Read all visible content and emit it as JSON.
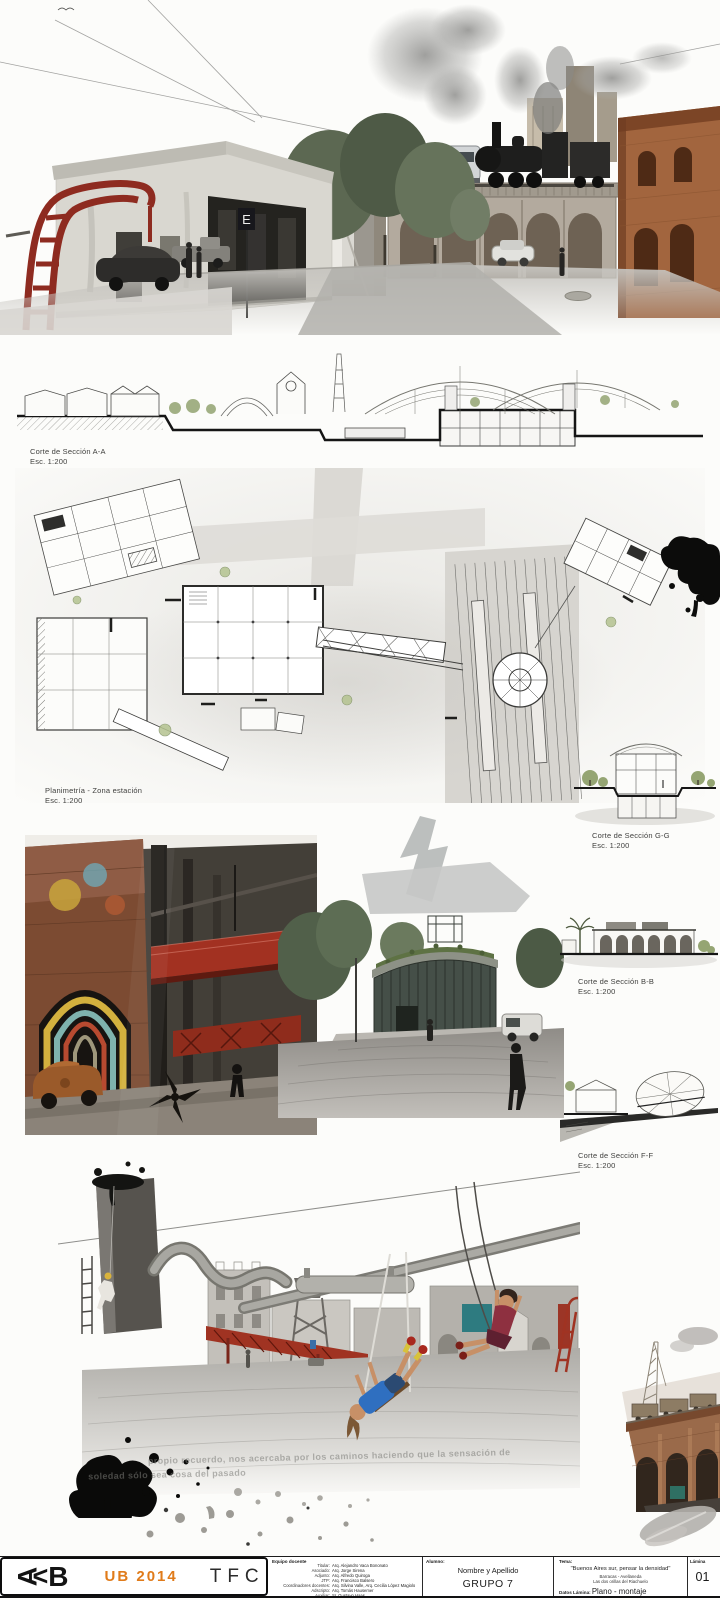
{
  "labels": {
    "section_aa": {
      "title": "Corte de Sección A-A",
      "scale": "Esc. 1:200"
    },
    "plan": {
      "title": "Planimetría - Zona estación",
      "scale": "Esc. 1:200"
    },
    "section_gg": {
      "title": "Corte de Sección G-G",
      "scale": "Esc. 1:200"
    },
    "section_bb": {
      "title": "Corte de Sección B-B",
      "scale": "Esc. 1:200"
    },
    "section_ff": {
      "title": "Corte de Sección F-F",
      "scale": "Esc. 1:200"
    }
  },
  "overlay_quote": {
    "line1": "propio recuerdo, nos acercaba por los caminos haciendo que la sensación de",
    "line2": "soledad sólo sea cosa del pasado"
  },
  "titleblock": {
    "logo": {
      "a": "A",
      "lt": "<",
      "b": "B"
    },
    "ub": "UB 2014",
    "tfc": "TFC",
    "equipo": {
      "heading": "Equipo docente",
      "rows": [
        {
          "role": "Titular:",
          "name": "Arq. Alejandro Vaca Bononato"
        },
        {
          "role": "Asociado:",
          "name": "Arq. Jorge Sirena"
        },
        {
          "role": "Adjunto:",
          "name": "Arq. Alfredo Quiroga"
        },
        {
          "role": "JTP:",
          "name": "Arq. Francisco Balsero"
        },
        {
          "role": "Coordinadores docentes:",
          "name": "Arq. Silvina Valle, Arq. Cecilia López Magiolo"
        },
        {
          "role": "Adscripto:",
          "name": "Arq. Tomás Hausemer"
        },
        {
          "role": "Auxiliar:",
          "name": "Sr. Gustavo Haas"
        }
      ]
    },
    "alumno": {
      "heading": "Alumno:",
      "name": "Nombre y Apellido",
      "group": "GRUPO 7"
    },
    "tema": {
      "heading": "Tema:",
      "line1": "\"Buenos Aires sur, pensar la densidad\"",
      "line2": "Barracas - Avellaneda",
      "line3": "Las dos orillas del Riachuelo",
      "datos_label": "Datos Lámina:",
      "datos_value": "Plano - montaje",
      "escala": "escala: 1:200",
      "fecha": "fecha: 30/06/2014"
    },
    "lamina": {
      "label": "Lámina",
      "number": "01"
    }
  },
  "colors": {
    "accent_orange": "#e07b1a",
    "ladder_red": "#8e2b20",
    "ink_black": "#0b0b0b"
  }
}
